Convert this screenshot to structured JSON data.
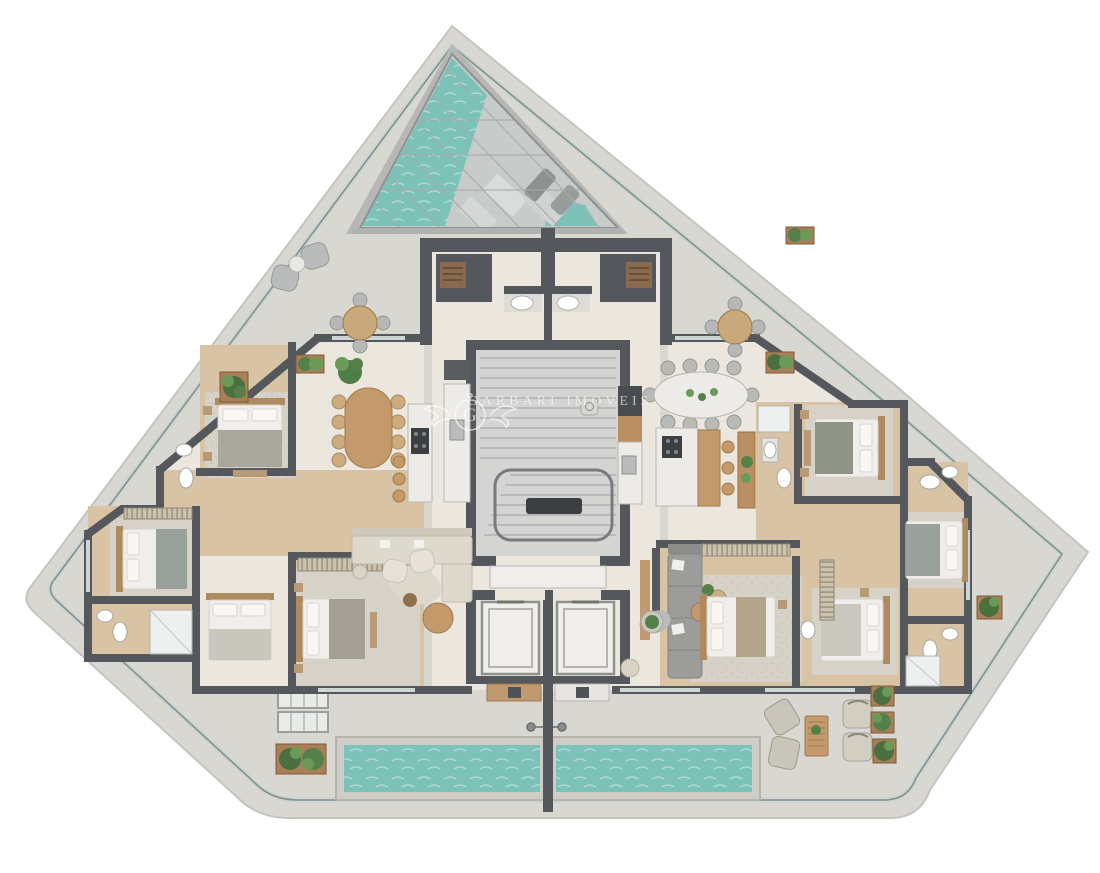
{
  "watermark": {
    "monogram": "G",
    "text": "GARBARI IMÓVEIS"
  },
  "colors": {
    "background": "#ffffff",
    "terrace_slab": "#d9d7d2",
    "slab_edge": "#c6c4bf",
    "railing_dark": "#7f938f",
    "railing_light": "#cdd3d0",
    "interior_floor": "#ebe7df",
    "wood_floor": "#d8c3a4",
    "wall": "#54575b",
    "pool_water": "#7cc2b9",
    "pool_coping": "#cfcdc8",
    "skylight_glass": "#c7cbca",
    "marble": "#edebe7",
    "wood_furniture": "#c49a6c",
    "sofa_beige": "#ded9cd",
    "sofa_grey": "#9c9c9a",
    "rug": "#d6d2c7",
    "bed_linen": "#efeeea",
    "plant_green": "#55804a"
  }
}
